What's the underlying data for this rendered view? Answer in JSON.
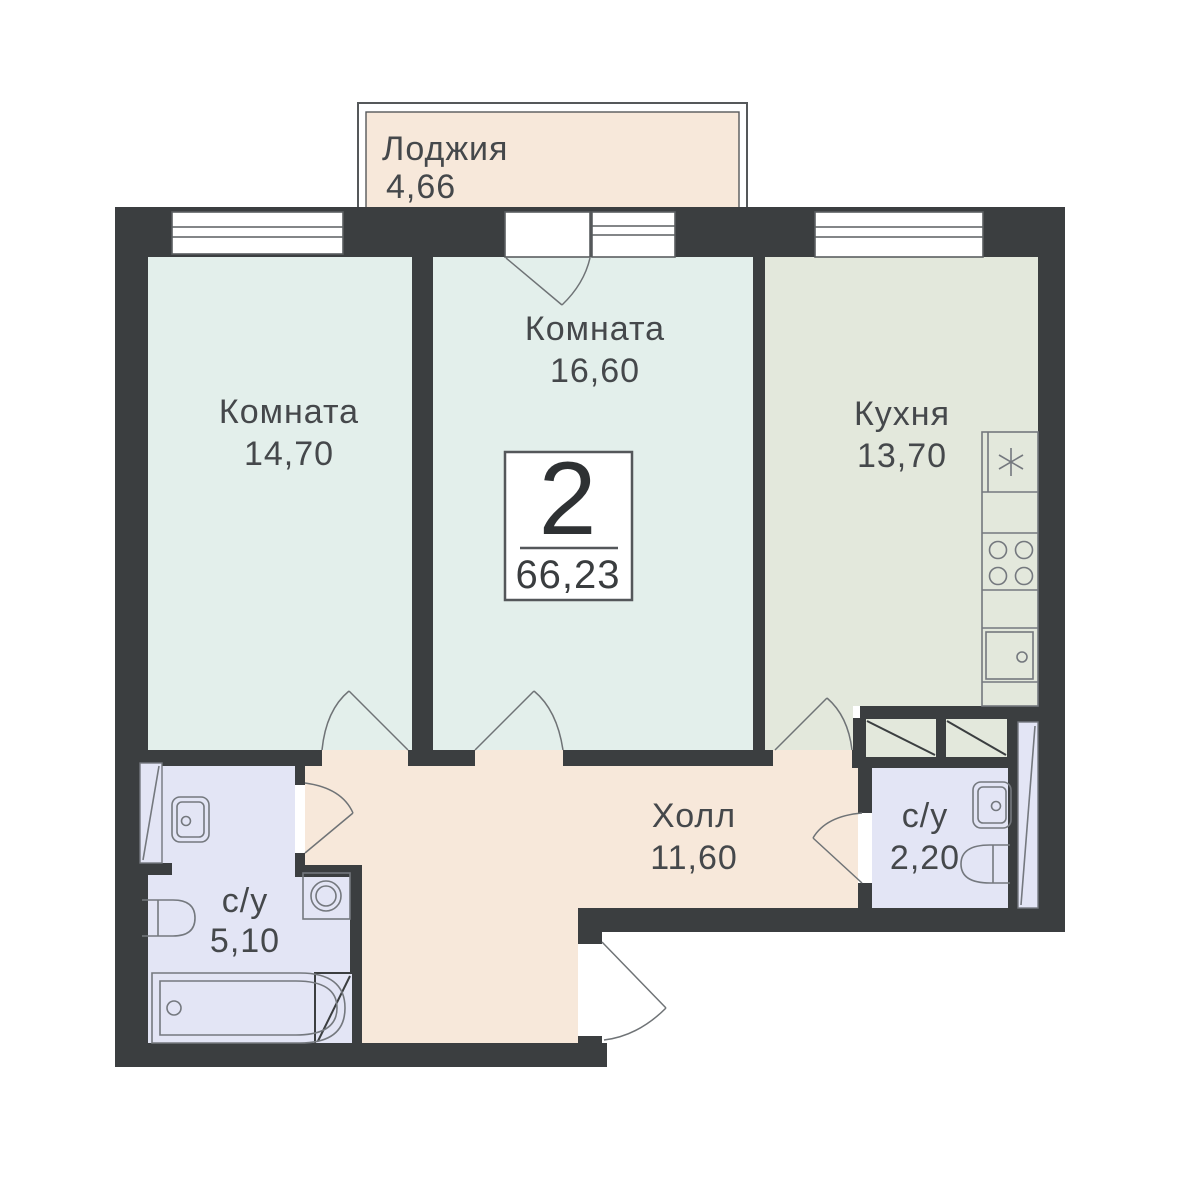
{
  "plan": {
    "type": "apartment-floorplan",
    "badge": {
      "rooms": "2",
      "total_area": "66,23"
    },
    "rooms": {
      "loggia": {
        "name": "Лоджия",
        "area": "4,66"
      },
      "room_left": {
        "name": "Комната",
        "area": "14,70"
      },
      "room_middle": {
        "name": "Комната",
        "area": "16,60"
      },
      "kitchen": {
        "name": "Кухня",
        "area": "13,70"
      },
      "hall": {
        "name": "Холл",
        "area": "11,60"
      },
      "bathroom_large": {
        "name": "с/у",
        "area": "5,10"
      },
      "bathroom_small": {
        "name": "с/у",
        "area": "2,20"
      }
    },
    "colors": {
      "wall": "#3b3e40",
      "room_fill": "#e3efeb",
      "kitchen_fill": "#e3e8dc",
      "hall_fill": "#f7e8da",
      "loggia_fill": "#f7e8da",
      "bathroom_fill": "#e3e5f5",
      "fixture_line": "#74787e",
      "text": "#45484b"
    }
  }
}
